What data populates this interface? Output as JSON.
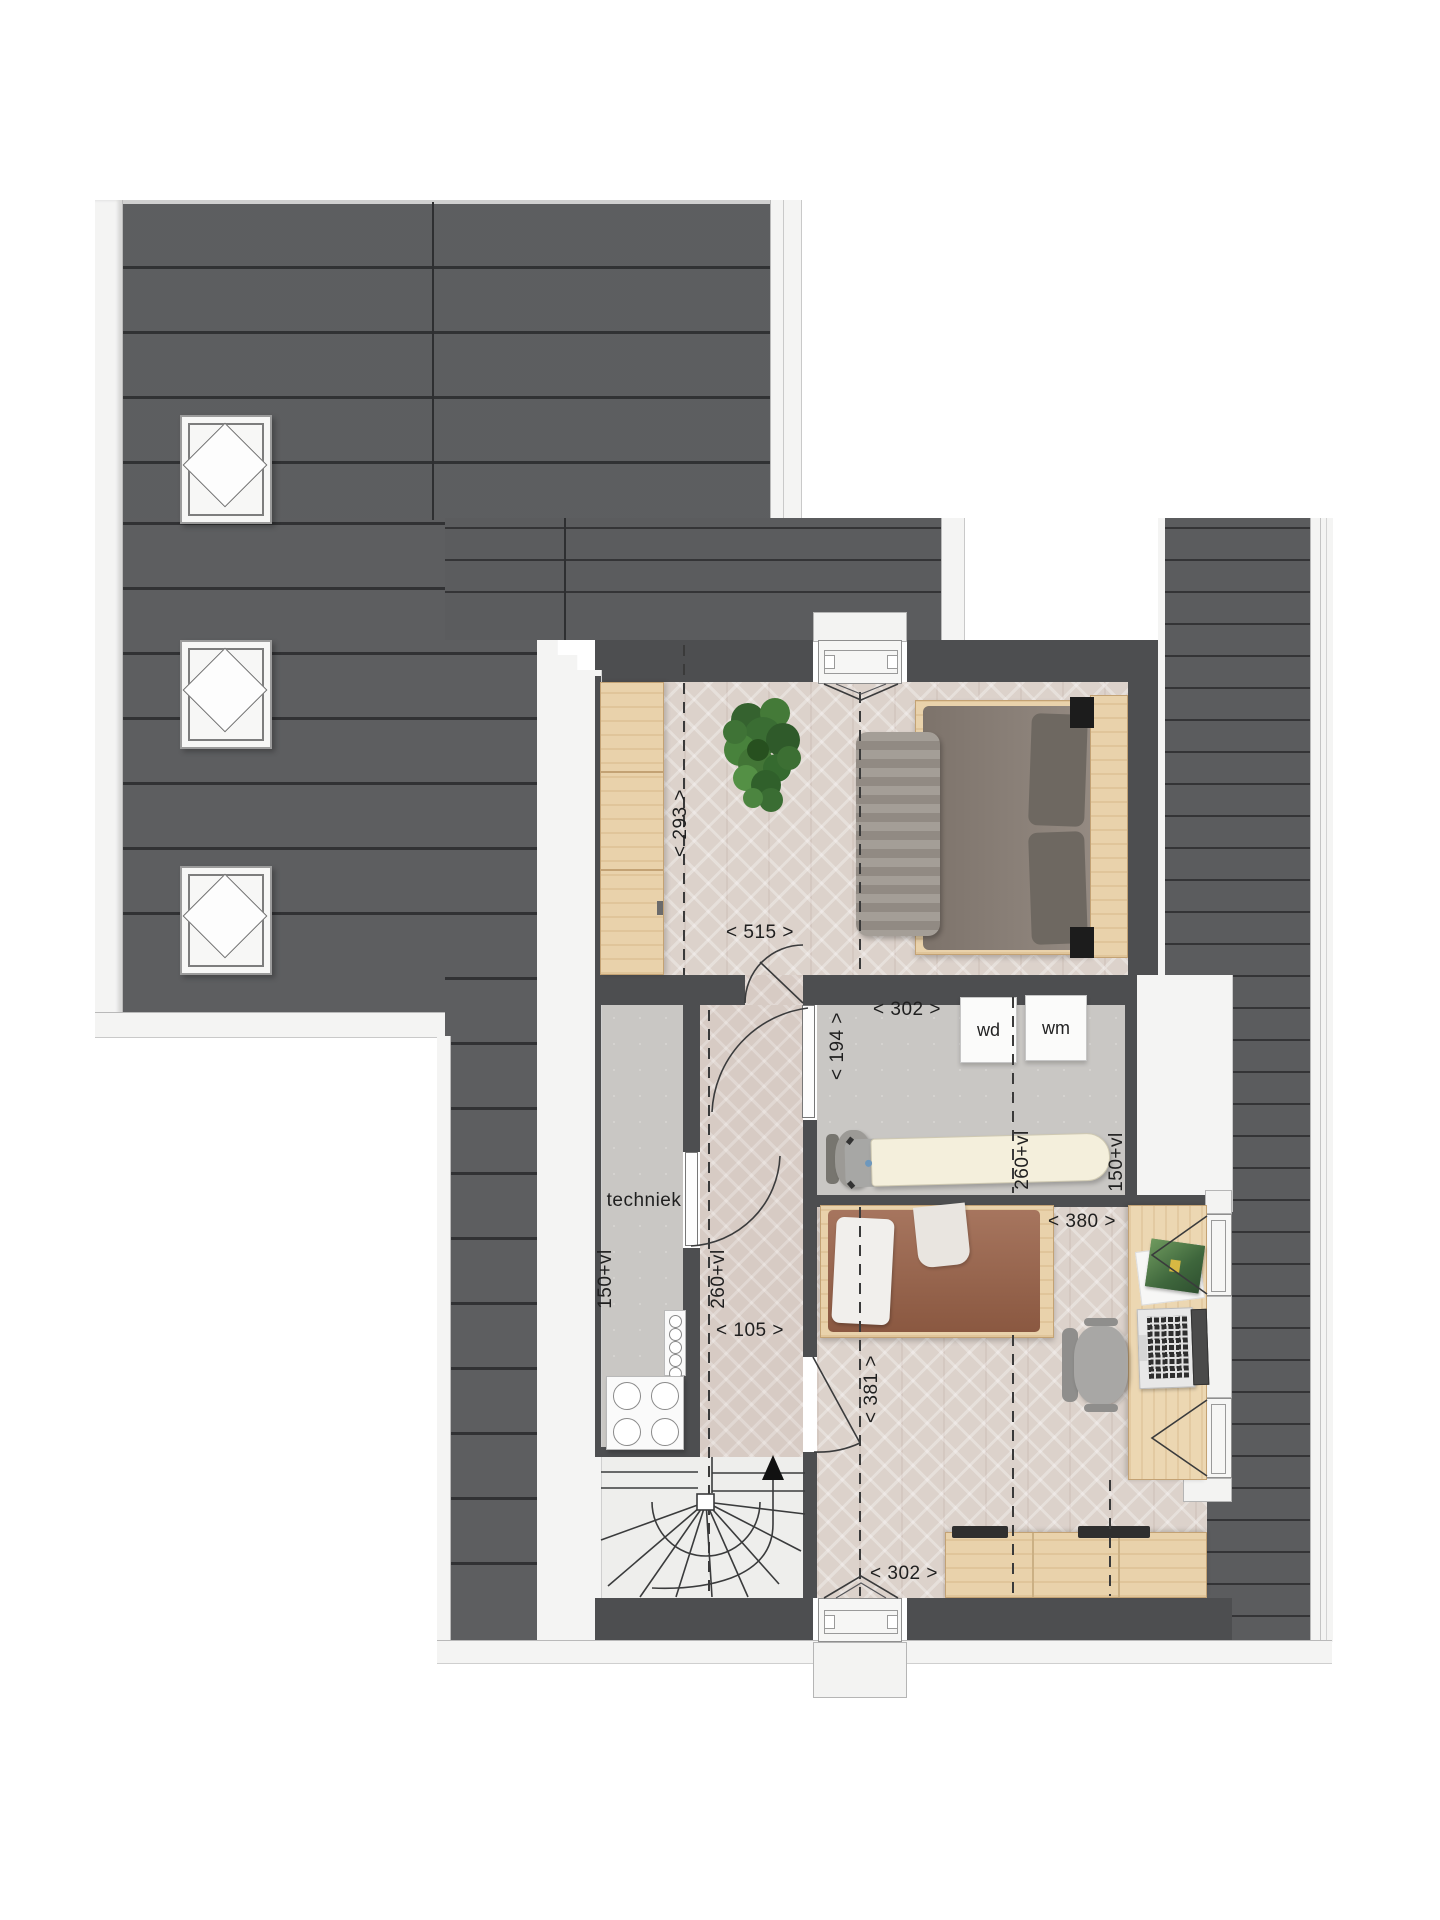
{
  "document": {
    "kind": "floor-plan",
    "level": "attic-floor",
    "language": "nl"
  },
  "labels": {
    "master_depth": "< 293 >",
    "master_width": "< 515 >",
    "laundry_width": "< 302 >",
    "laundry_depth": "< 194 >",
    "laundry_vl_260": "260+vl",
    "laundry_vl_150": "150+vl",
    "techniek": "techniek",
    "techniek_vl_150": "150+vl",
    "hall_vl_260": "260+vl",
    "hall_width": "< 105 >",
    "bedroom2_depth": "< 381 >",
    "bedroom2_desk_width": "< 380 >",
    "bedroom2_width": "< 302 >",
    "dryer": "wd",
    "washer": "wm"
  },
  "rooms": [
    {
      "name": "master-bedroom",
      "floor": "parquet-herringbone"
    },
    {
      "name": "laundry-room",
      "floor": "concrete",
      "appliances": [
        "wd",
        "wm"
      ]
    },
    {
      "name": "techniek",
      "floor": "concrete",
      "appliances": [
        "heat-pump",
        "manifold"
      ]
    },
    {
      "name": "hall",
      "floor": "parquet-herringbone"
    },
    {
      "name": "bedroom-2",
      "floor": "parquet-herringbone"
    },
    {
      "name": "stairwell",
      "feature": "winder-stairs-up"
    }
  ],
  "colors": {
    "roof": "#565759",
    "wall": "#4d4e50",
    "trim": "#f4f4f3",
    "parquet": "#dcd2cb",
    "concrete": "#c9c7c4",
    "wood": "#e9d2ab",
    "bed1_duvet": "#8b8077",
    "bed2_duvet": "#9a6248",
    "plant_green": "#3a6d33",
    "label_text": "#1f1f1f"
  }
}
